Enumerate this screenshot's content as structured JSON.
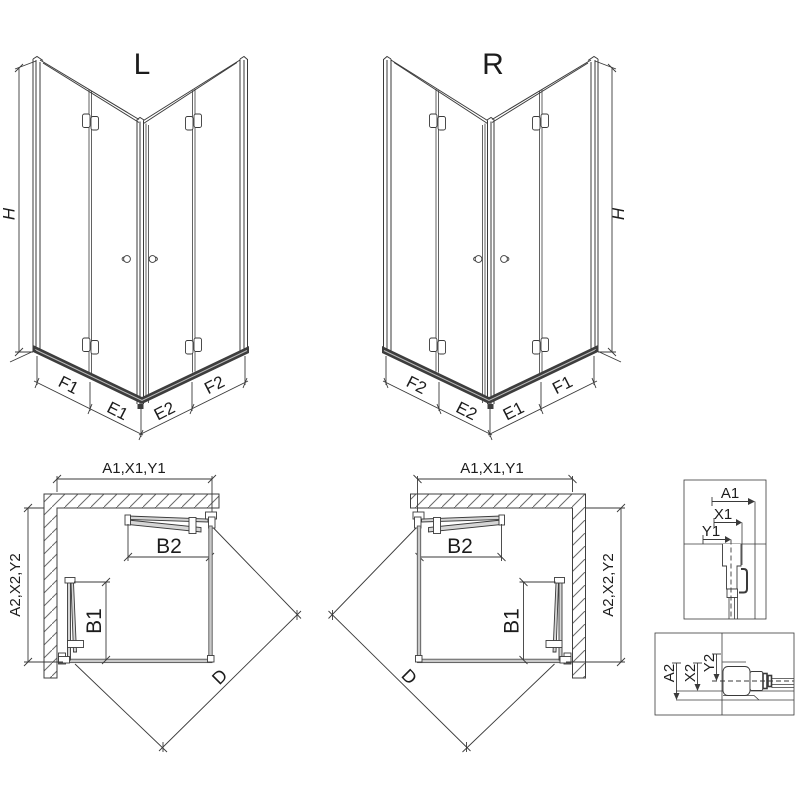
{
  "drawing": {
    "variant_left_label": "L",
    "variant_right_label": "R",
    "height_label": "H",
    "segment_labels": {
      "f1": "F1",
      "e1": "E1",
      "e2": "E2",
      "f2": "F2"
    },
    "plan_labels": {
      "width": "A1,X1,Y1",
      "depth": "A2,X2,Y2",
      "door_top": "B2",
      "door_side": "B1",
      "diagonal": "D"
    },
    "detail_top_labels": {
      "a1": "A1",
      "x1": "X1",
      "y1": "Y1"
    },
    "detail_bottom_labels": {
      "a2": "A2",
      "x2": "X2",
      "y2": "Y2"
    },
    "colors": {
      "line": "#3a3a3a",
      "panel_gray": "#c9c9c9",
      "door_gray": "#d6d6d6",
      "sill_dark": "#3d3d3d",
      "background": "#ffffff"
    }
  }
}
